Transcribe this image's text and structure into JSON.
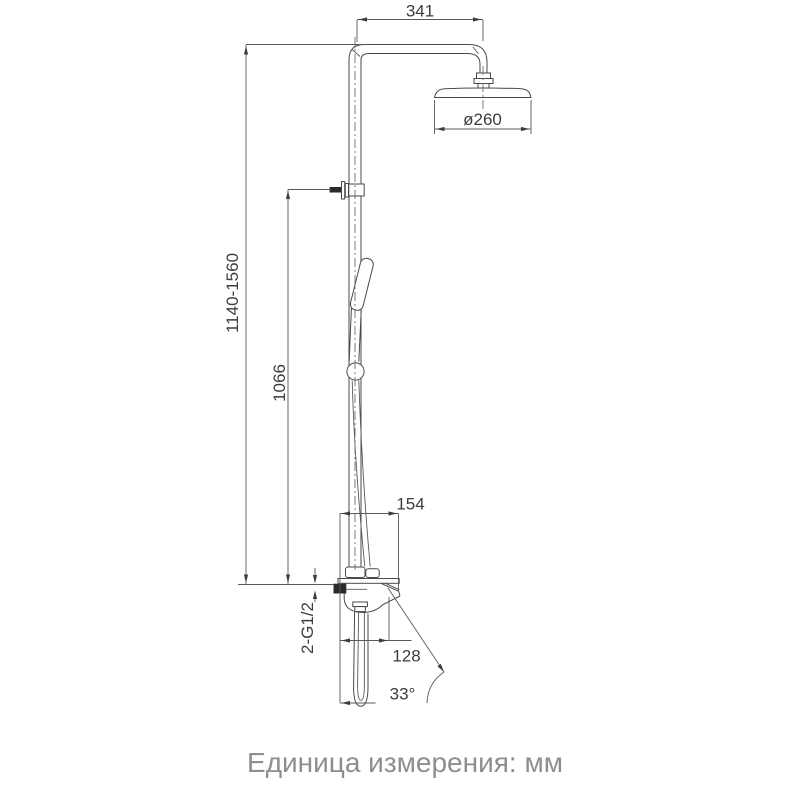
{
  "dims": {
    "arm_width": "341",
    "head_diameter": "ø260",
    "total_height": "1140-1560",
    "riser_height": "1066",
    "body_width": "154",
    "spout_reach": "128",
    "inlet_thread": "2-G1/2",
    "spout_angle": "33°"
  },
  "caption": "Единица измерения: мм",
  "colors": {
    "line": "#4a4a4a",
    "dimension_text": "#3d3d3d",
    "caption_text": "#8e8e8e",
    "background": "#ffffff"
  }
}
